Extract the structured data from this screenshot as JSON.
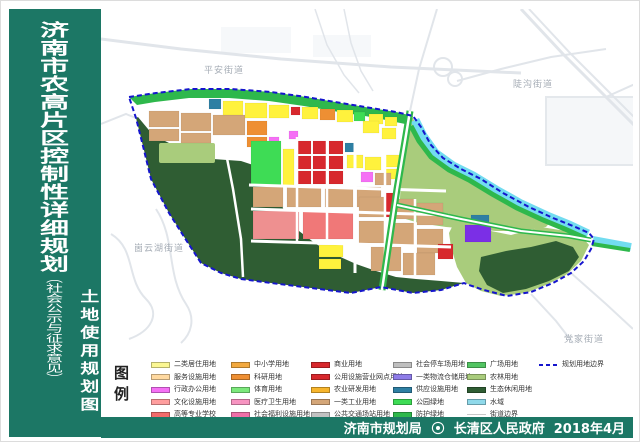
{
  "sidebar": {
    "title": "济南市农高片区控制性详细规划",
    "title_suffix": "（社会公示与征求意见）",
    "map_type": "土地使用规划图"
  },
  "map": {
    "labels": {
      "pingan": "平安街道",
      "dougou": "陡沟街道",
      "guyunhu": "崮云湖街道",
      "dangjia": "党家街道"
    }
  },
  "legend": {
    "title": "图例",
    "columns": [
      {
        "items": [
          {
            "label": "二类居住用地",
            "color": "#fbf793"
          },
          {
            "label": "服务设施用地",
            "color": "#ffd9a0"
          },
          {
            "label": "行政办公用地",
            "color": "#f570f5"
          },
          {
            "label": "文化设施用地",
            "color": "#ff9e9e"
          },
          {
            "label": "高等专业学校",
            "color": "#f26b6b"
          }
        ]
      },
      {
        "items": [
          {
            "label": "中小学用地",
            "color": "#f2a93f"
          },
          {
            "label": "科研用地",
            "color": "#ee8f33"
          },
          {
            "label": "体育用地",
            "color": "#7ce87c"
          },
          {
            "label": "医疗卫生用地",
            "color": "#f794c1"
          },
          {
            "label": "社会福利设施用地",
            "color": "#f06fa8"
          }
        ]
      },
      {
        "items": [
          {
            "label": "商业用地",
            "color": "#d7282d"
          },
          {
            "label": "公用设施营业网点用地",
            "color": "#d7282d"
          },
          {
            "label": "农业研发用地",
            "color": "#f7b52c"
          },
          {
            "label": "一类工业用地",
            "color": "#d4a678"
          },
          {
            "label": "公共交通场站用地",
            "color": "#c2c2c2"
          }
        ]
      },
      {
        "items": [
          {
            "label": "社会停车场用地",
            "color": "#bfbfbf"
          },
          {
            "label": "一类物流仓储用地",
            "color": "#8e7ce8"
          },
          {
            "label": "供应设施用地",
            "color": "#2e7fa3"
          },
          {
            "label": "公园绿地",
            "color": "#3edc55"
          },
          {
            "label": "防护绿地",
            "color": "#2eb84c"
          }
        ]
      },
      {
        "items": [
          {
            "label": "广场用地",
            "color": "#52c462"
          },
          {
            "label": "农林用地",
            "color": "#a9cc7c"
          },
          {
            "label": "生态休闲用地",
            "color": "#2f5d33"
          },
          {
            "label": "水域",
            "color": "#8fd9ea"
          },
          {
            "label": "街道边界",
            "color": "#c8c8c8",
            "line": true
          }
        ]
      },
      {
        "items": [
          {
            "label": "规划用地边界",
            "color": "#1515cd",
            "dashed": true
          }
        ]
      }
    ]
  },
  "footer": {
    "left_agency": "济南市规划局",
    "right_agency": "长清区人民政府",
    "date": "2018年4月",
    "seal_icon": "government-seal"
  },
  "colors": {
    "sidebar_green": "#1c7765",
    "boundary_blue": "#1515cd",
    "water_cyan": "#72dcf0",
    "eco_dark_green": "#2f5d33",
    "farm_light_green": "#a9cc7c",
    "park_green": "#3edc55",
    "protective_green": "#2eb84c",
    "industry_tan": "#d4a678",
    "commercial_red": "#d7282d"
  }
}
